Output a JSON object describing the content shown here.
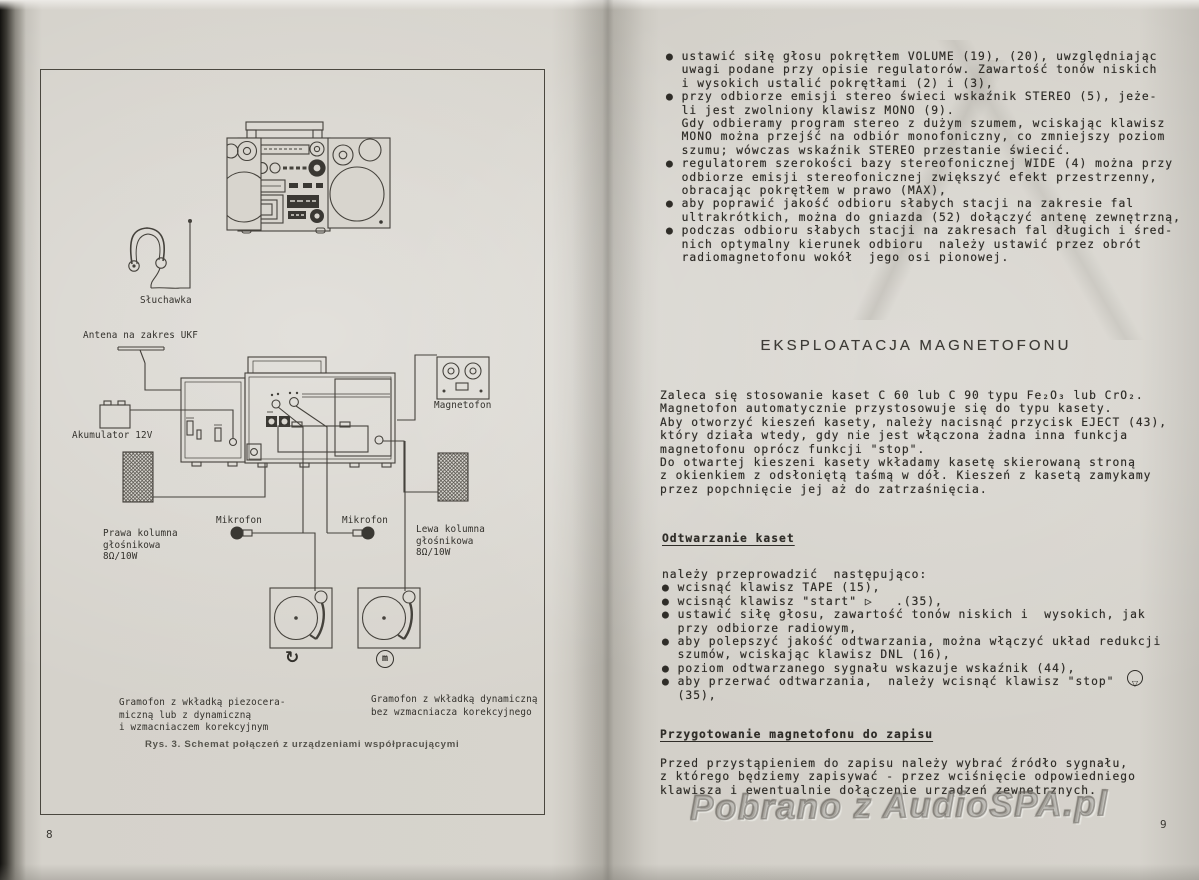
{
  "page_left": {
    "page_number": "8",
    "caption": "Rys. 3. Schemat połączeń z urządzeniami współpracującymi",
    "labels": {
      "headphones": "Słuchawka",
      "antenna": "Antena na zakres UKF",
      "battery": "Akumulator 12V",
      "tape_recorder": "Magnetofon",
      "right_speaker": [
        "Prawa kolumna",
        "głośnikowa",
        "8Ω/10W"
      ],
      "left_speaker": [
        "Lewa kolumna",
        "głośnikowa",
        "8Ω/10W"
      ],
      "microphone_1": "Mikrofon",
      "microphone_2": "Mikrofon",
      "turntable_piezo": [
        "Gramofon z wkładką piezocera-",
        "miczną lub z dynamiczną",
        "i wzmacniaczem korekcyjnym"
      ],
      "turntable_dynamic": [
        "Gramofon z wkładką dynamiczną",
        "bez wzmacniacza korekcyjnego"
      ],
      "symbol_rotation": "↻",
      "symbol_dynamic": "m"
    }
  },
  "page_right": {
    "page_number": "9",
    "radio_bullets_lines": [
      "● ustawić siłę głosu pokrętłem VOLUME (19), (20), uwzględniając",
      "  uwagi podane przy opisie regulatorów. Zawartość tonów niskich",
      "  i wysokich ustalić pokrętłami (2) i (3),",
      "● przy odbiorze emisji stereo świeci wskaźnik STEREO (5), jeże-",
      "  li jest zwolniony klawisz MONO (9).",
      "  Gdy odbieramy program stereo z dużym szumem, wciskając klawisz",
      "  MONO można przejść na odbiór monofoniczny, co zmniejszy poziom",
      "  szumu; wówczas wskaźnik STEREO przestanie świecić.",
      "● regulatorem szerokości bazy stereofonicznej WIDE (4) można przy",
      "  odbiorze emisji stereofonicznej zwiększyć efekt przestrzenny,",
      "  obracając pokrętłem w prawo (MAX),",
      "● aby poprawić jakość odbioru słabych stacji na zakresie fal",
      "  ultrakrótkich, można do gniazda (52) dołączyć antenę zewnętrzną,",
      "● podczas odbioru słabych stacji na zakresach fal długich i śred-",
      "  nich optymalny kierunek odbioru  należy ustawić przez obrót",
      "  radiomagnetofonu wokół  jego osi pionowej."
    ],
    "heading": "EKSPLOATACJA MAGNETOFONU",
    "intro_lines": [
      "Zaleca się stosowanie kaset C 60 lub C 90 typu Fe₂O₃ lub CrO₂.",
      "Magnetofon automatycznie przystosowuje się do typu kasety.",
      "Aby otworzyć kieszeń kasety, należy nacisnąć przycisk EJECT (43),",
      "który działa wtedy, gdy nie jest włączona żadna inna funkcja",
      "magnetofonu oprócz funkcji \"stop\".",
      "Do otwartej kieszeni kasety wkładamy kasetę skierowaną stroną",
      "z okienkiem z odsłoniętą taśmą w dół. Kieszeń z kasetą zamykamy",
      "przez popchnięcie jej aż do zatrzaśnięcia."
    ],
    "subheading_playback": "Odtwarzanie kaset",
    "playback_lines": [
      "należy przeprowadzić  następująco:",
      "● wcisnąć klawisz TAPE (15),",
      "● wcisnąć klawisz \"start\" ▷   .(35),",
      "● ustawić siłę głosu, zawartość tonów niskich i  wysokich, jak",
      "  przy odbiorze radiowym,",
      "● aby polepszyć jakość odtwarzania, można włączyć układ redukcji",
      "  szumów, wciskając klawisz DNL (16),",
      "● poziom odtwarzanego sygnału wskazuje wskaźnik (44),",
      "● aby przerwać odtwarzania,  należy wcisnąć klawisz \"stop\"",
      "  (35),"
    ],
    "stop_symbol": "▽",
    "subheading_record": "Przygotowanie magnetofonu do zapisu",
    "record_lines": [
      "Przed przystąpieniem do zapisu należy wybrać źródło sygnału,",
      "z którego będziemy zapisywać - przez wciśnięcie odpowiedniego",
      "klawisza i ewentualnie dołączenie urządzeń zewnętrznych."
    ]
  },
  "watermark": "Pobrano z AudioSPA.pl"
}
